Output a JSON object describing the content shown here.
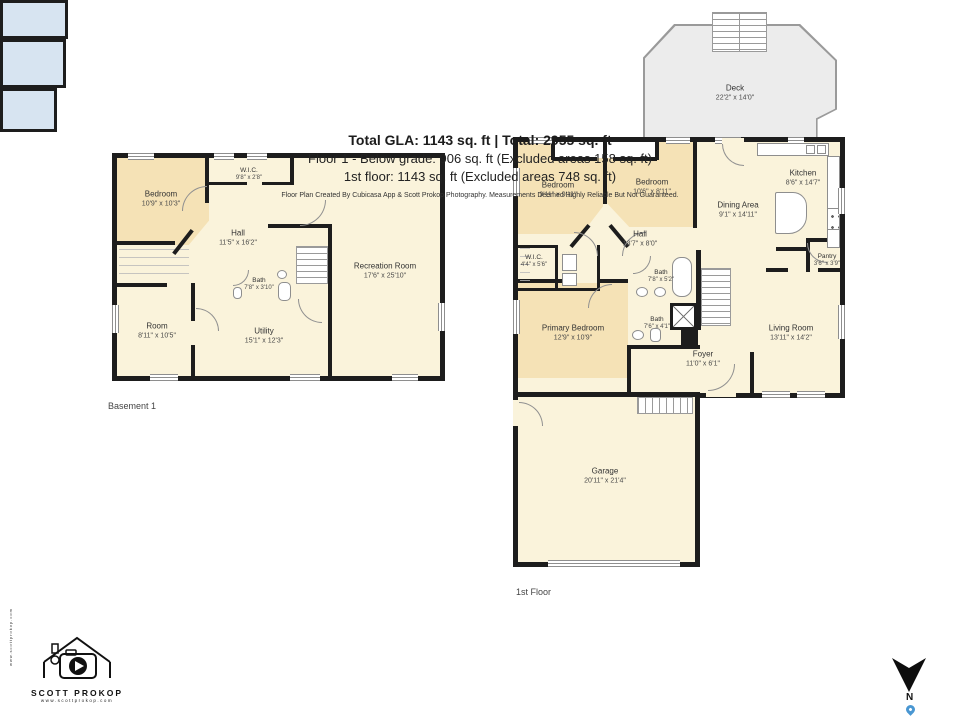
{
  "basement": {
    "floor_label": "Basement 1",
    "rooms": {
      "bedroom": {
        "name": "Bedroom",
        "dims": "10'9\" x 10'3\""
      },
      "wic": {
        "name": "W.I.C.",
        "dims": "9'8\" x 2'8\""
      },
      "hall": {
        "name": "Hall",
        "dims": "11'5\" x 16'2\""
      },
      "bath": {
        "name": "Bath",
        "dims": "7'8\" x 3'10\""
      },
      "recreation": {
        "name": "Recreation Room",
        "dims": "17'6\" x 25'10\""
      },
      "room": {
        "name": "Room",
        "dims": "8'11\" x 10'5\""
      },
      "utility": {
        "name": "Utility",
        "dims": "15'1\" x 12'3\""
      }
    }
  },
  "first_floor": {
    "floor_label": "1st Floor",
    "rooms": {
      "deck": {
        "name": "Deck",
        "dims": "22'2\" x 14'0\""
      },
      "bedroom_left": {
        "name": "Bedroom",
        "dims": "9'11\" x 9'11\""
      },
      "bedroom_right": {
        "name": "Bedroom",
        "dims": "10'6\" x 8'11\""
      },
      "kitchen": {
        "name": "Kitchen",
        "dims": "8'6\" x 14'7\""
      },
      "dining": {
        "name": "Dining Area",
        "dims": "9'1\" x 14'11\""
      },
      "pantry": {
        "name": "Pantry",
        "dims": "3'6\" x 3'9\""
      },
      "hall": {
        "name": "Hall",
        "dims": "13'7\" x 8'0\""
      },
      "wic": {
        "name": "W.I.C.",
        "dims": "4'4\" x 5'6\""
      },
      "bath_upper": {
        "name": "Bath",
        "dims": "7'8\" x 5'2\""
      },
      "bath_lower": {
        "name": "Bath",
        "dims": "7'6\" x 4'1\""
      },
      "primary": {
        "name": "Primary Bedroom",
        "dims": "12'9\" x 10'9\""
      },
      "foyer": {
        "name": "Foyer",
        "dims": "11'0\" x 6'1\""
      },
      "living": {
        "name": "Living Room",
        "dims": "13'11\" x 14'2\""
      },
      "garage": {
        "name": "Garage",
        "dims": "20'11\" x 21'4\""
      }
    }
  },
  "summary": {
    "total_line": "Total GLA: 1143 sq. ft | Total: 2955 sq. ft",
    "floor1_line": "Floor 1 - Below grade: 906 sq. ft (Excluded areas 158 sq. ft)",
    "first_floor_line": "1st floor: 1143 sq. ft (Excluded areas 748 sq. ft)",
    "disclaimer": "Floor Plan Created By Cubicasa App & Scott Prokop Photography. Measurements Deemed Highly Reliable But Not Guaranteed."
  },
  "branding": {
    "name": "SCOTT PROKOP",
    "website": "www.scottprokop.com"
  },
  "compass": {
    "label": "N"
  },
  "colors": {
    "wall": "#1D1D1D",
    "floor": "#FAF3DB",
    "bedroom": "#F5E2B6",
    "bath": "#D7E4F1",
    "deck": "#ECECEC"
  }
}
